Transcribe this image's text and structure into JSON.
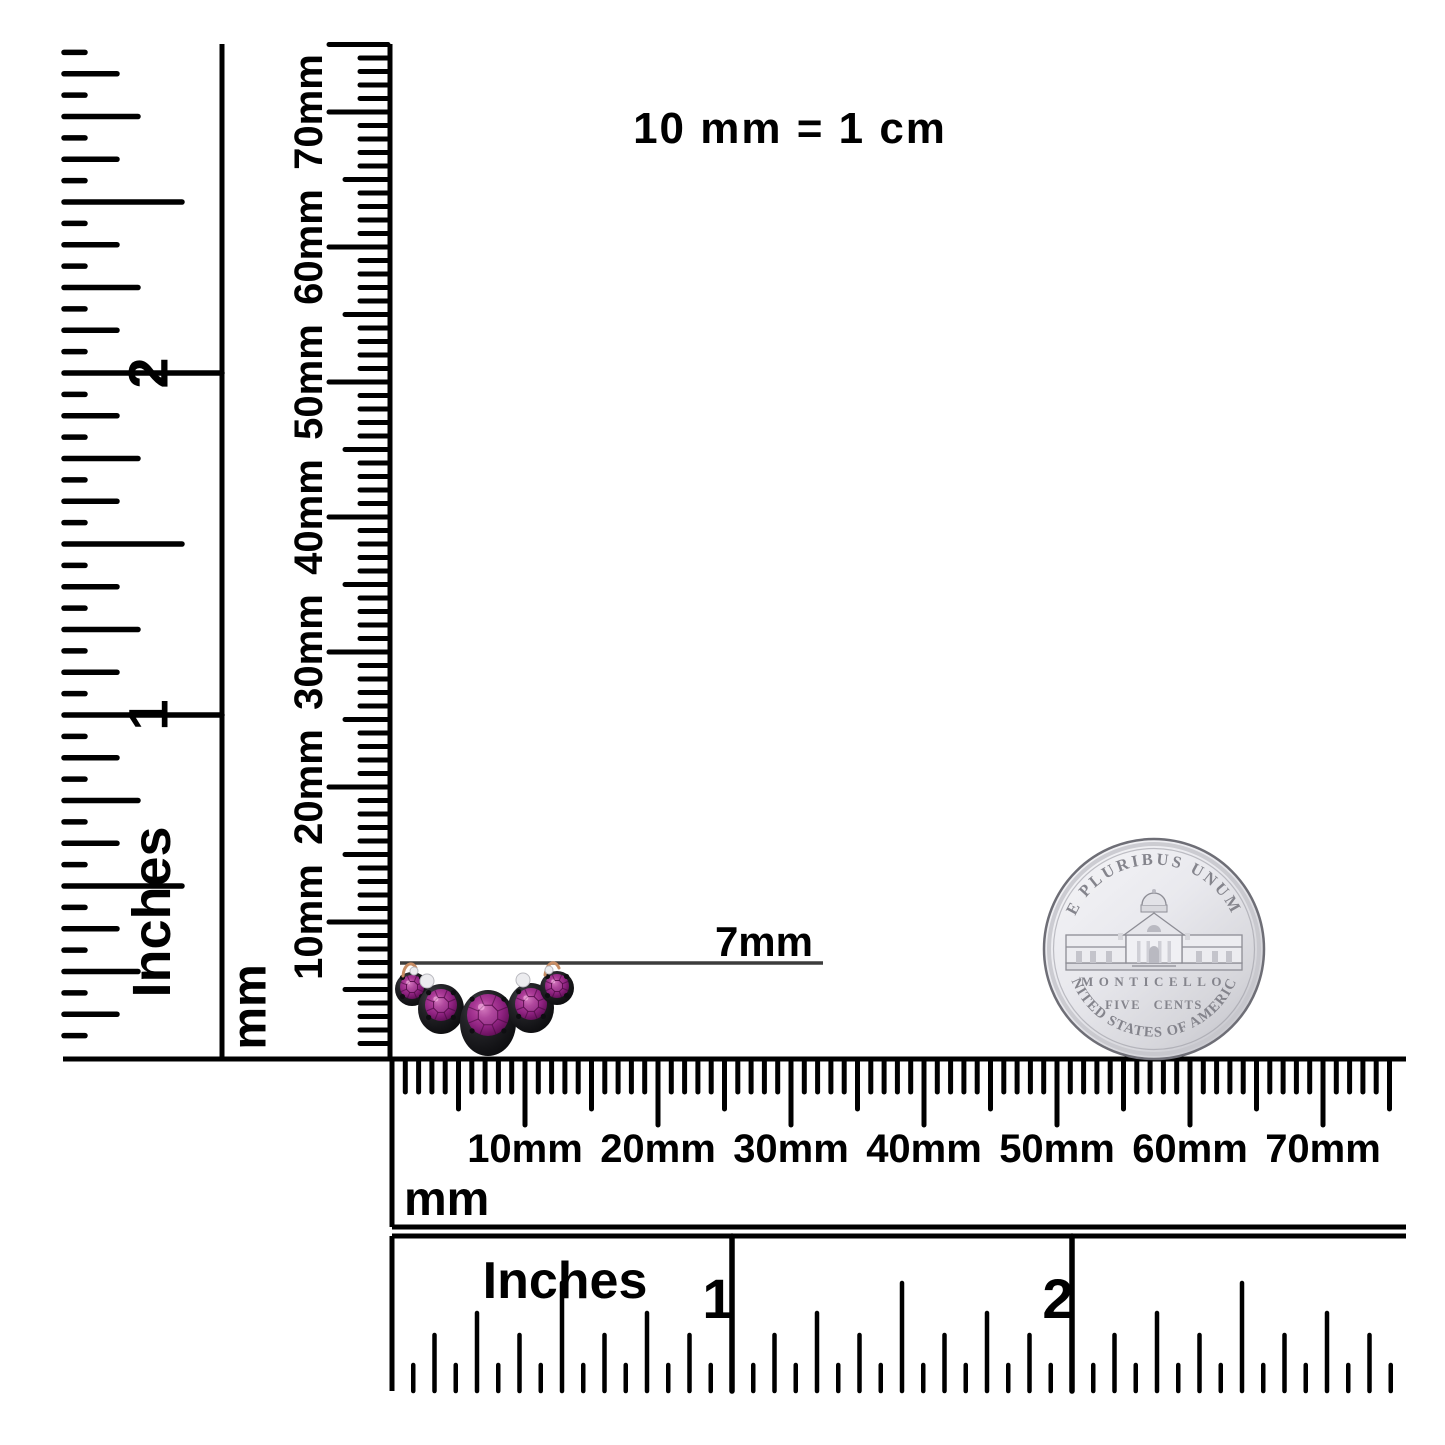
{
  "scale_note": "10 mm = 1 cm",
  "measurement": {
    "label": "7mm"
  },
  "rulers": {
    "left_inches": {
      "unit_label": "Inches",
      "numerals": [
        {
          "label": "1",
          "value": 1
        },
        {
          "label": "2",
          "value": 2
        }
      ],
      "max_sixteenths": 47
    },
    "left_mm": {
      "unit_label": "mm",
      "labels": [
        "10mm",
        "20mm",
        "30mm",
        "40mm",
        "50mm",
        "60mm",
        "70mm"
      ],
      "max_mm": 75
    },
    "bottom_mm": {
      "unit_label": "mm",
      "labels": [
        "10mm",
        "20mm",
        "30mm",
        "40mm",
        "50mm",
        "60mm",
        "70mm"
      ],
      "max_mm": 75
    },
    "bottom_inches": {
      "unit_label": "Inches",
      "numerals": [
        {
          "label": "1",
          "value": 1
        },
        {
          "label": "2",
          "value": 2
        }
      ],
      "max_sixteenths": 47
    }
  },
  "geometry": {
    "left_inches": {
      "line_x": 222,
      "top_y": 44,
      "tick_x": 64,
      "origin_y": 1057,
      "px_per_sixteenth": 21.375,
      "len_sixteenth": 21,
      "len_eighth": 53,
      "len_quarter": 74,
      "len_half": 118,
      "len_inch": 158,
      "numeral_x": 148,
      "unit_x": 152,
      "unit_y": 912
    },
    "left_mm": {
      "line_x": 390,
      "top_y": 44,
      "origin_y": 1057,
      "px_per_mm": 13.5,
      "len_minor": 28,
      "len_five": 43,
      "len_ten": 59,
      "label_x": 309,
      "unit_x": 250,
      "unit_y": 1007
    },
    "bottom_mm": {
      "origin_x": 392,
      "top_y": 1061,
      "bottom_y": 1227,
      "right_x": 1406,
      "px_per_mm": 13.3,
      "len_minor": 31,
      "len_five": 48,
      "len_ten": 64,
      "label_y": 1162,
      "unit_x": 404,
      "unit_y": 1215
    },
    "bottom_inches": {
      "origin_x": 392,
      "top_y": 1236,
      "base_y": 1391,
      "right_x": 1406,
      "px_per_sixteenth": 21.25,
      "len_sixteenth": 26,
      "len_eighth": 56,
      "len_quarter": 78,
      "len_half": 108,
      "numeral_y": 1318,
      "numeral_dx": -14,
      "unit_x": 565,
      "unit_y": 1298
    },
    "measure_line": {
      "x1": 400,
      "x2": 823,
      "y": 963,
      "label_x": 813,
      "label_y": 956
    },
    "note_pos": {
      "x": 790,
      "y": 143
    }
  },
  "jewelry": {
    "stones": [
      {
        "cx": 412,
        "cy": 989,
        "brx": 17,
        "bry": 17,
        "scy": 987,
        "r": 12
      },
      {
        "cx": 441,
        "cy": 1009,
        "brx": 23,
        "bry": 25,
        "scy": 1005,
        "r": 16
      },
      {
        "cx": 488,
        "cy": 1023,
        "brx": 28,
        "bry": 33,
        "scy": 1015,
        "r": 21
      },
      {
        "cx": 531,
        "cy": 1008,
        "brx": 23,
        "bry": 25,
        "scy": 1004,
        "r": 16
      },
      {
        "cx": 557,
        "cy": 988,
        "brx": 17,
        "bry": 17,
        "scy": 986,
        "r": 12
      }
    ],
    "accents": [
      {
        "kind": "wire",
        "d": "M 403 976 C 404 964 412 960 416 968"
      },
      {
        "kind": "wire",
        "d": "M 545 975 C 547 962 555 959 559 968"
      },
      {
        "kind": "silver",
        "cx": 427,
        "cy": 981,
        "r": 7
      },
      {
        "kind": "silver",
        "cx": 523,
        "cy": 980,
        "r": 7
      },
      {
        "kind": "silver",
        "cx": 414,
        "cy": 971,
        "r": 4
      },
      {
        "kind": "silver",
        "cx": 549,
        "cy": 970,
        "r": 4
      }
    ],
    "colors": {
      "bezel": "#17171a",
      "stone": "#93267f",
      "stone_light": "#cf6cb8",
      "stone_dark": "#4c0b44",
      "wire": "#c78c63"
    }
  },
  "coin": {
    "top_text": "E PLURIBUS UNUM",
    "building_label": "MONTICELLO",
    "denomination": "FIVE CENTS",
    "bottom_text": "UNITED STATES OF AMERICA",
    "cx": 1154,
    "cy": 949,
    "r": 110,
    "colors": {
      "face": "#e9e9ed",
      "edge": "#6e6e76",
      "text": "#84848c"
    }
  },
  "colors": {
    "ink": "#000000",
    "background": "#ffffff",
    "measure_line": "#3c3c3c"
  }
}
